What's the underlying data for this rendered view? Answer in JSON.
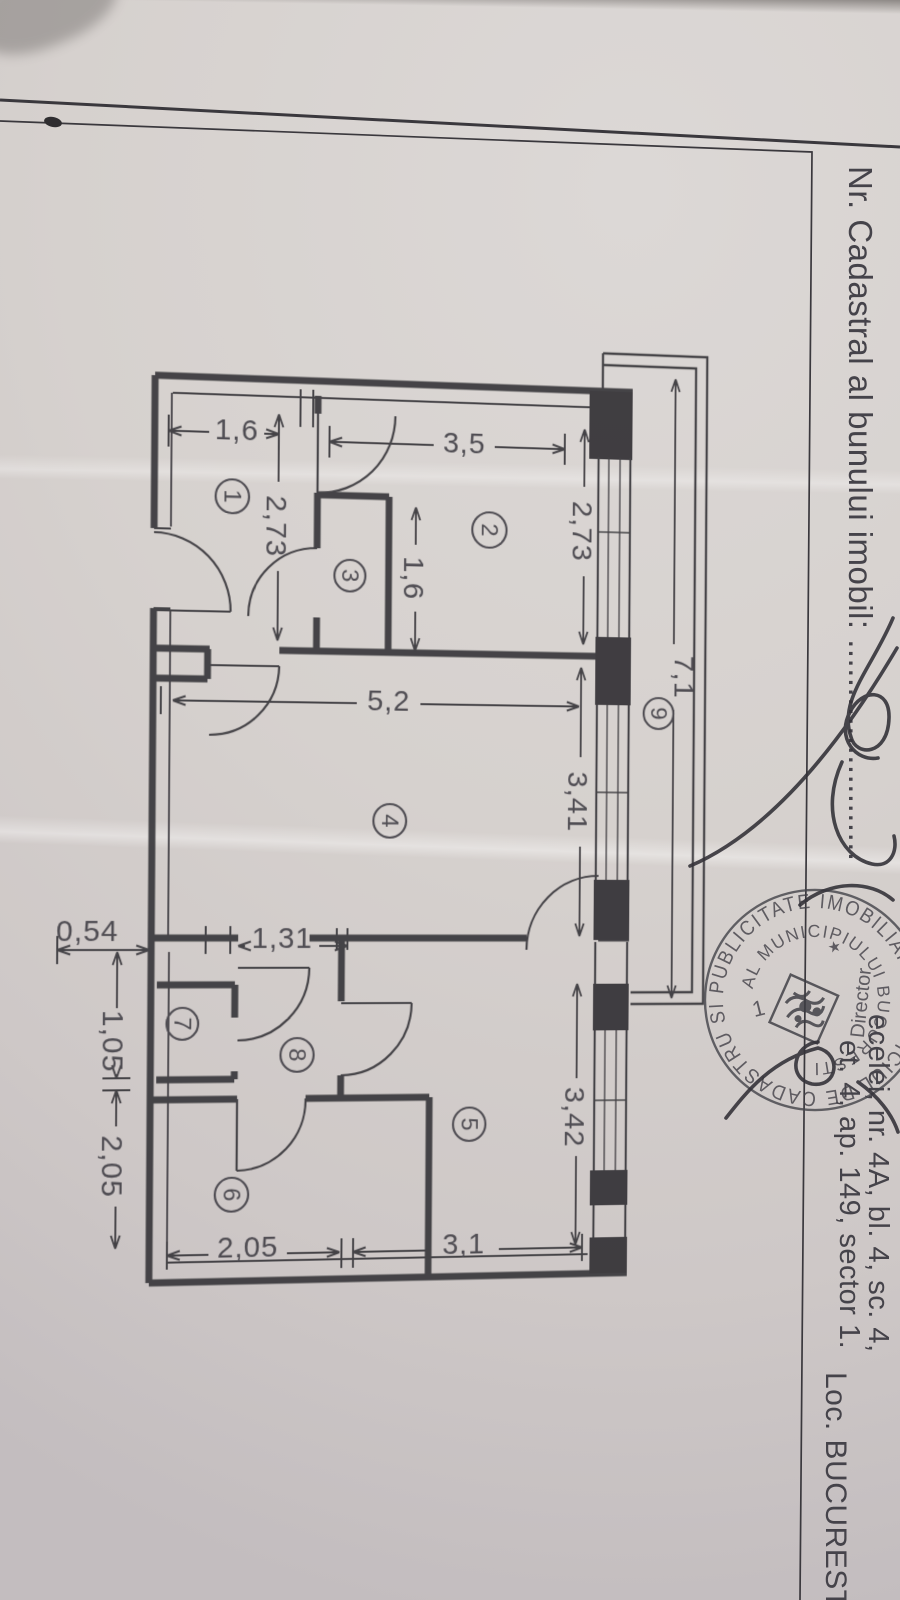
{
  "header": {
    "cadastral_label": "Nr. Cadastral al bunului imobil: ......................."
  },
  "address": {
    "line1": "ecelei, nr. 4A, bl. 4, sc. 4,",
    "line2": "et. 4, ap. 149, sector 1.",
    "locality": "Loc. BUCURESTI."
  },
  "stamp": {
    "outer_ring": "SI PUBLICITATE IMOBILIARA ★ OFICIUL DE CADASTRU ",
    "inner_ring": "AL MUNICIPIULUI BUCURESTI",
    "role": "Director",
    "star": "★",
    "center_number": "1"
  },
  "floor_plan": {
    "rooms": [
      {
        "n": "1",
        "c": [
          231,
          494
        ],
        "r": 17
      },
      {
        "n": "2",
        "c": [
          497,
          521
        ],
        "r": 18
      },
      {
        "n": "3",
        "c": [
          352,
          571
        ],
        "r": 16
      },
      {
        "n": "4",
        "c": [
          395,
          819
        ],
        "r": 17
      },
      {
        "n": "5",
        "c": [
          480,
          1128
        ],
        "r": 17
      },
      {
        "n": "6",
        "c": [
          235,
          1196
        ],
        "r": 17
      },
      {
        "n": "7",
        "c": [
          184,
          1024
        ],
        "r": 16
      },
      {
        "n": "8",
        "c": [
          301,
          1056
        ],
        "r": 17
      },
      {
        "n": "9",
        "c": [
          678,
          706
        ],
        "r": 16
      }
    ],
    "dimensions": [
      {
        "v": "1,6",
        "o": "h",
        "pos": 430,
        "span": [
          166,
          278
        ],
        "gap": [
          207,
          263
        ],
        "label": [
          235,
          427
        ],
        "rot": false
      },
      {
        "v": "3,5",
        "o": "h",
        "pos": 436,
        "span": [
          330,
          576
        ],
        "gap": [
          438,
          502
        ],
        "label": [
          470,
          433
        ],
        "rot": false
      },
      {
        "v": "2,73",
        "o": "v",
        "pos": 278,
        "span": [
          410,
          638
        ],
        "gap": [
          478,
          568
        ],
        "label": [
          276,
          523
        ],
        "rot": true
      },
      {
        "v": "1,6",
        "o": "v",
        "pos": 420,
        "span": [
          500,
          646
        ],
        "gap": [
          538,
          606
        ],
        "label": [
          418,
          572
        ],
        "rot": true
      },
      {
        "v": "2,73",
        "o": "v",
        "pos": 597,
        "span": [
          415,
          636
        ],
        "gap": [
          474,
          566
        ],
        "label": [
          595,
          520
        ],
        "rot": true
      },
      {
        "v": "5,2",
        "o": "h",
        "pos": 700,
        "span": [
          172,
          593
        ],
        "gap": [
          360,
          426
        ],
        "label": [
          393,
          697
        ],
        "rot": false
      },
      {
        "v": "3,41",
        "o": "v",
        "pos": 595,
        "span": [
          660,
          936
        ],
        "gap": [
          752,
          844
        ],
        "label": [
          593,
          798
        ],
        "rot": true
      },
      {
        "v": "7,1",
        "o": "v",
        "pos": 694,
        "span": [
          360,
          1000
        ],
        "gap": [
          634,
          702
        ],
        "label": [
          705,
          668
        ],
        "rot": true
      },
      {
        "v": "0,54",
        "o": "h",
        "pos": 950,
        "span": [
          58,
          150
        ],
        "gap": null,
        "label": [
          88,
          931
        ],
        "rot": false
      },
      {
        "v": "1,31",
        "o": "h",
        "pos": 946,
        "span": [
          240,
          352
        ],
        "gap": [
          247,
          323
        ],
        "label": [
          285,
          938
        ],
        "rot": false
      },
      {
        "v": "1,05",
        "o": "v",
        "pos": 118,
        "span": [
          952,
          1078
        ],
        "gap": [
          1008,
          1074
        ],
        "label": [
          114,
          1041
        ],
        "rot": true
      },
      {
        "v": "2,05",
        "o": "v",
        "pos": 118,
        "span": [
          1090,
          1248
        ],
        "gap": [
          1126,
          1206
        ],
        "label": [
          114,
          1166
        ],
        "rot": true
      },
      {
        "v": "2,05",
        "o": "h",
        "pos": 1256,
        "span": [
          170,
          346
        ],
        "gap": [
          212,
          292
        ],
        "label": [
          252,
          1249
        ],
        "rot": false
      },
      {
        "v": "3,1",
        "o": "h",
        "pos": 1256,
        "span": [
          360,
          600
        ],
        "gap": [
          438,
          512
        ],
        "label": [
          475,
          1250
        ],
        "rot": false
      },
      {
        "v": "3,42",
        "o": "v",
        "pos": 593,
        "span": [
          985,
          1253
        ],
        "gap": [
          1082,
          1162
        ],
        "label": [
          591,
          1122
        ],
        "rot": true
      }
    ]
  }
}
